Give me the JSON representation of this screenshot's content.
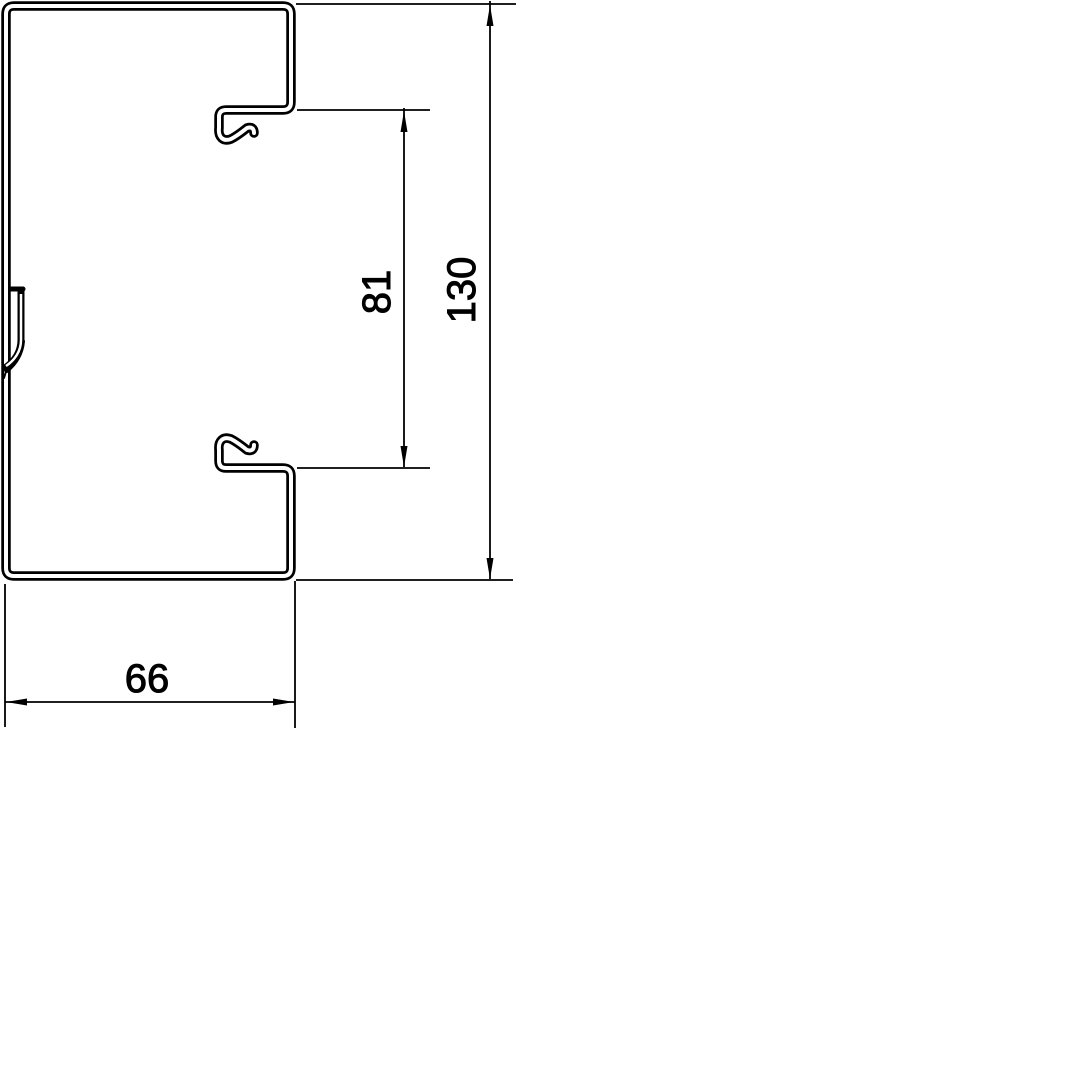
{
  "diagram": {
    "background_color": "#ffffff",
    "line_color": "#000000",
    "labels": {
      "overall_height": "130",
      "opening_height": "81",
      "overall_width": "66"
    }
  }
}
